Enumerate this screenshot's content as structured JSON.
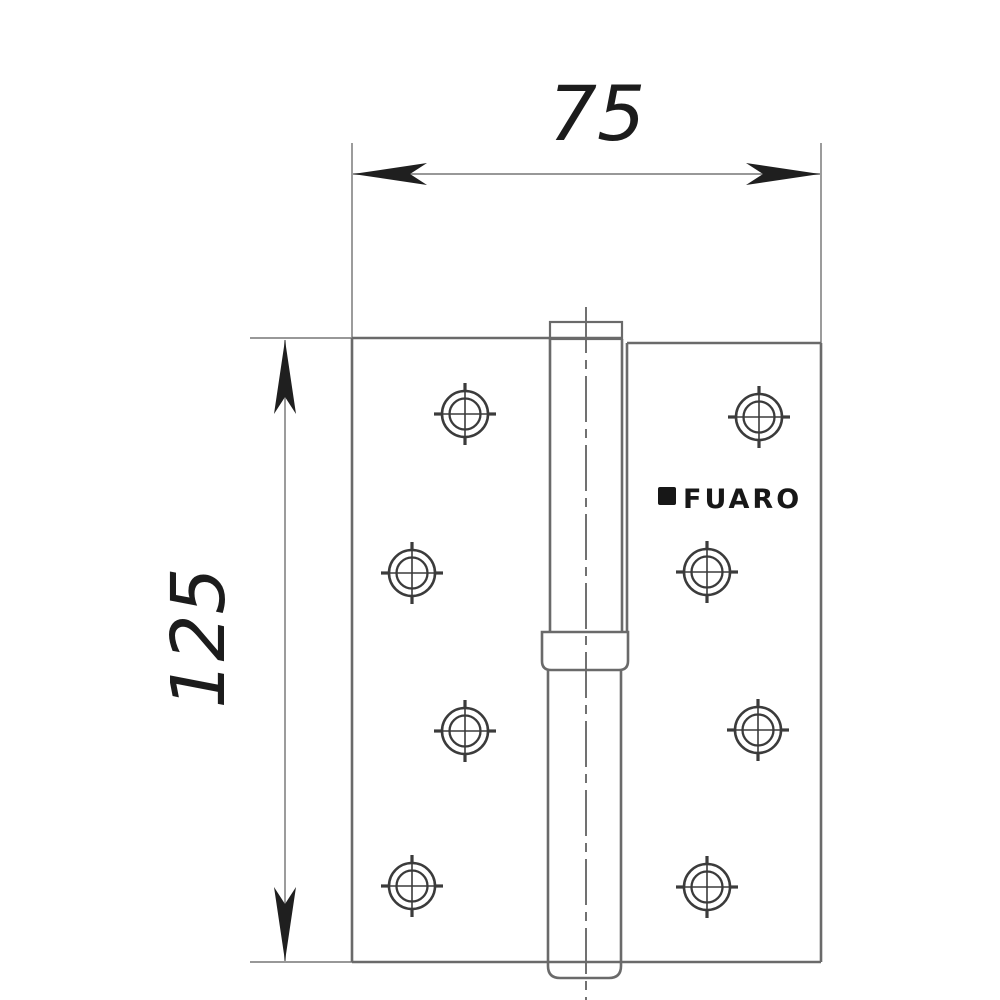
{
  "drawing": {
    "type": "technical-dimension-drawing",
    "subject": "lift-off door hinge, front view",
    "dimensions": {
      "width_label": "75",
      "height_label": "125"
    },
    "logo_text": "FUARO",
    "holes": [
      {
        "cx": 465,
        "cy": 414
      },
      {
        "cx": 412,
        "cy": 573
      },
      {
        "cx": 465,
        "cy": 731
      },
      {
        "cx": 412,
        "cy": 886
      },
      {
        "cx": 759,
        "cy": 417
      },
      {
        "cx": 707,
        "cy": 572
      },
      {
        "cx": 758,
        "cy": 730
      },
      {
        "cx": 707,
        "cy": 887
      }
    ],
    "hole_style": {
      "outer_radius": 23,
      "inner_radius": 15.5,
      "cross_extent": 31
    },
    "colors": {
      "background": "#ffffff",
      "outline": "#6a6a6a",
      "dimension_line": "#8a8a8a",
      "arrow": "#1f1f1f",
      "dimension_text": "#1c1c1c",
      "hole_stroke": "#3b3b3b",
      "logo": "#171717"
    }
  }
}
